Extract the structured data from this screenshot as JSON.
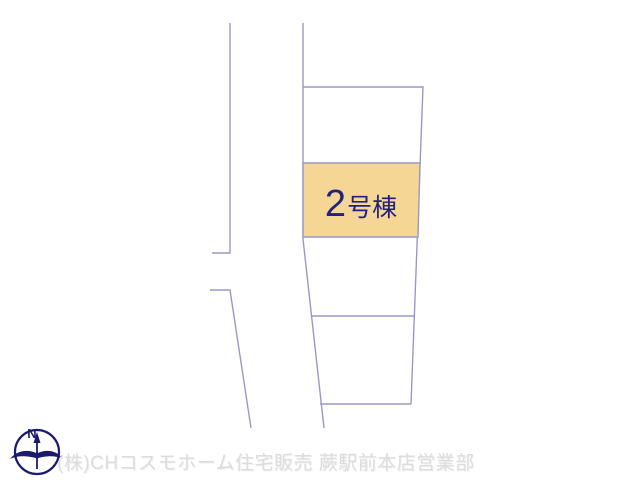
{
  "plan": {
    "highlighted_lot": {
      "number": "2",
      "suffix": "号棟",
      "label": "2号棟"
    },
    "colors": {
      "background": "#ffffff",
      "boundary_line": "#989ac4",
      "highlight_fill": "#f6d694",
      "lot_label_text": "#22227d",
      "compass": "#1b1b6e",
      "watermark_text": "#dcdcdc"
    }
  },
  "compass": {
    "north_label": "N"
  },
  "footer": {
    "watermark": "(株)CHコスモホーム住宅販売 蕨駅前本店営業部"
  }
}
